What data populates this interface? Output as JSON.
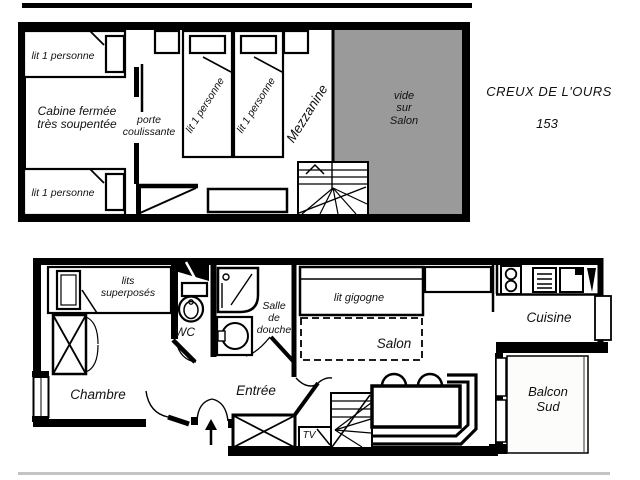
{
  "header": {
    "resort_name": "CREUX DE L'OURS",
    "unit_number": "153"
  },
  "colors": {
    "wall": "#000000",
    "void_fill": "#9a9a9a",
    "ground_shadow": "#c4c4c4",
    "paper": "#ffffff"
  },
  "upper_floor": {
    "cabin_bed_top_label": "lit 1 personne",
    "cabin_bed_bottom_label": "lit 1 personne",
    "cabin_label": "Cabine fermée\ntrès soupentée",
    "sliding_door_label": "porte\ncoulissante",
    "mezzanine_bed_left_label": "lit 1 personne",
    "mezzanine_bed_right_label": "lit 1 personne",
    "mezzanine_label": "Mezzanine",
    "void_label": "vide\nsur\nSalon"
  },
  "lower_floor": {
    "bunk_beds_label": "lits\nsuperposés",
    "wc_label": "WC",
    "shower_room_label": "Salle\nde\ndouche",
    "bedroom_label": "Chambre",
    "entry_label": "Entrée",
    "pullout_bed_label": "lit gigogne",
    "living_room_label": "Salon",
    "kitchen_label": "Cuisine",
    "balcony_label": "Balcon\nSud",
    "tv_label": "TV"
  }
}
